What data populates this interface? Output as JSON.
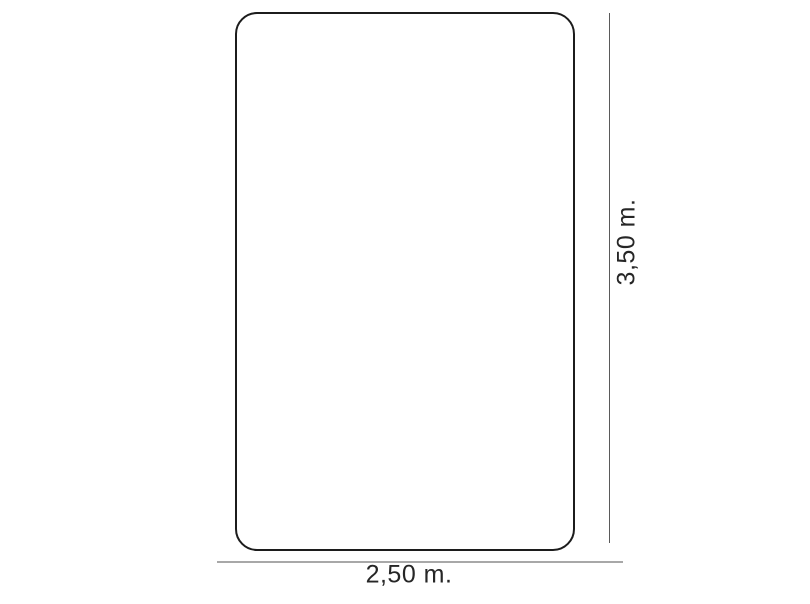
{
  "diagram": {
    "type": "dimension-drawing",
    "shape": "rounded-rectangle",
    "height_label": "3,50 m.",
    "width_label": "2,50 m.",
    "colors": {
      "background": "#ffffff",
      "outline": "#1c1c1c",
      "height_dimension_line": "#5a5a5a",
      "width_dimension_line": "#a8a8a8",
      "label_text": "#262626"
    }
  }
}
